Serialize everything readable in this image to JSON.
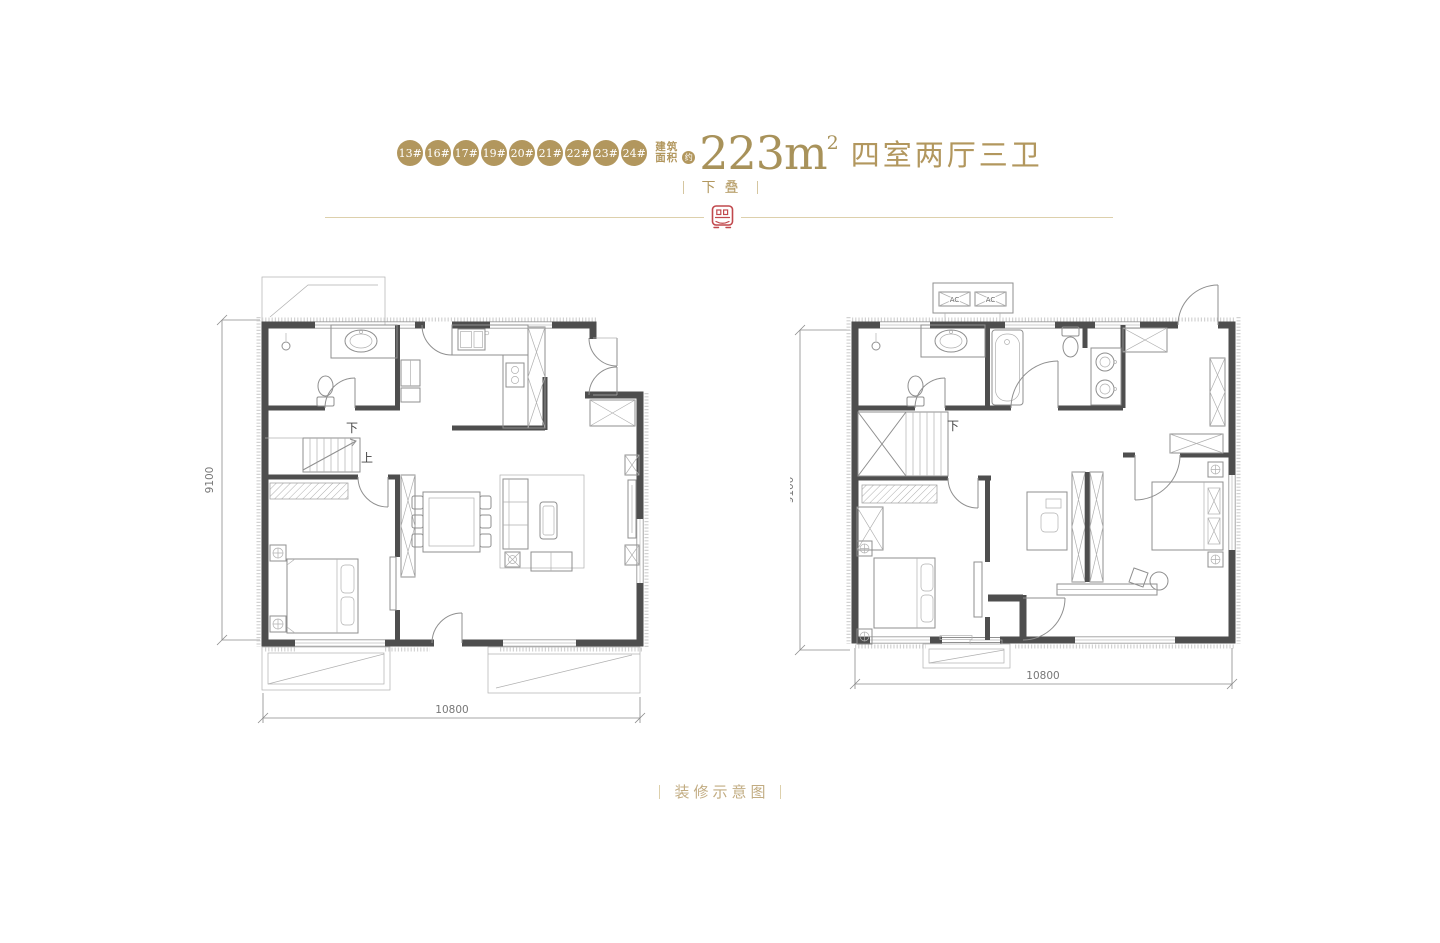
{
  "header": {
    "badges": [
      "13#",
      "16#",
      "17#",
      "19#",
      "20#",
      "21#",
      "22#",
      "23#",
      "24#"
    ],
    "area_label_top": "建筑",
    "area_label_bottom": "面积",
    "approx": "约",
    "area_value": "223m",
    "area_exponent": "2",
    "layout_type": "四室两厅三卫",
    "level_tag": "下叠"
  },
  "floor_plans": {
    "left": {
      "height_dim": "9100",
      "width_dim": "10800",
      "stairs_down": "下",
      "stairs_up": "上"
    },
    "right": {
      "height_dim": "9100",
      "width_dim": "10800",
      "stairs_down": "下",
      "ac_units": [
        "AC",
        "AC"
      ]
    }
  },
  "footer": {
    "caption": "装修示意图"
  },
  "colors": {
    "gold": "#b2975e",
    "gold_light": "#ddd0ac",
    "seal_red": "#c1484d",
    "wall_dark": "#4e4e4e",
    "line_gray": "#8f8f8f"
  }
}
